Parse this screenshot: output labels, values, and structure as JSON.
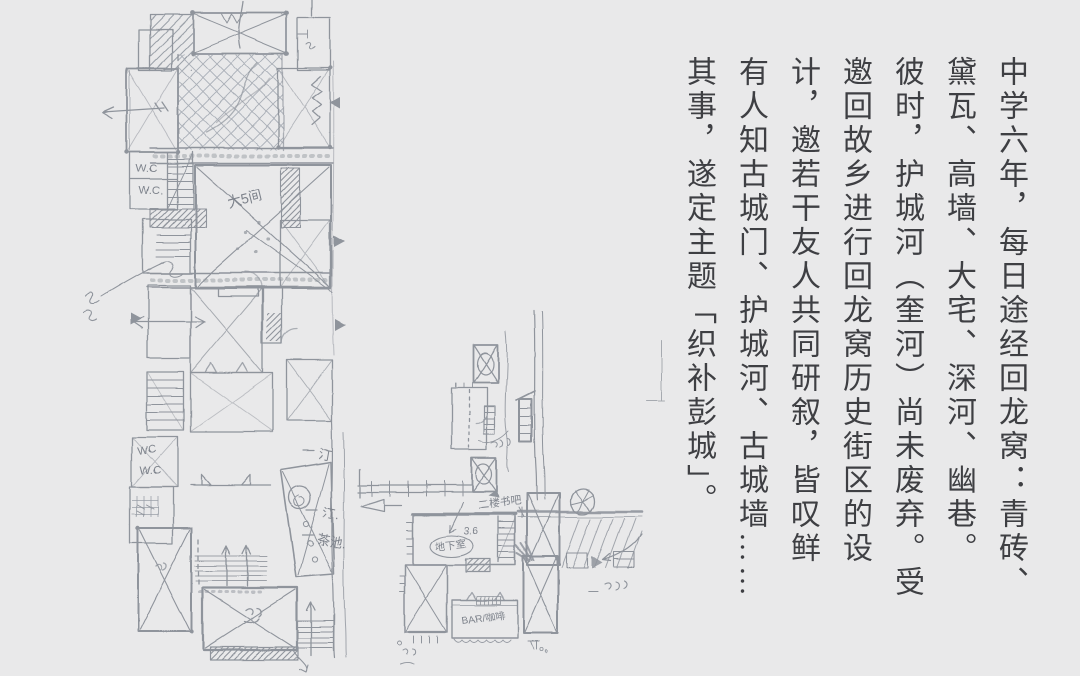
{
  "colors": {
    "background": "#e9e9ea",
    "sketch_ink": "#8f949c",
    "essay_text": "#3e3f43"
  },
  "text_panel": {
    "columns": [
      "中学六年，每日途经回龙窝：青砖、",
      "黛瓦、高墙、大宅、深河、幽巷。",
      "彼时，护城河（奎河）尚未废弃。受",
      "邀回故乡进行回龙窝历史街区的设",
      "计，邀若干友人共同研叙，皆叹鲜",
      "有人知古城门、护城河、古城墙……",
      "其事，遂定主题「织补彭城」。"
    ]
  },
  "sketch": {
    "labels": {
      "wc_upper_1": "W.C",
      "wc_upper_2": "W.C.",
      "wc_lower_1": "WC",
      "wc_lower_2": "W.C",
      "hall": "大5间",
      "ting_1": "汀",
      "ting_2": "汀.",
      "tea_pond": "茶池.",
      "second_floor_bar": "二楼书吧",
      "depth": "3.6",
      "basement": "地下室",
      "bar": "BAR/咖啡"
    }
  }
}
